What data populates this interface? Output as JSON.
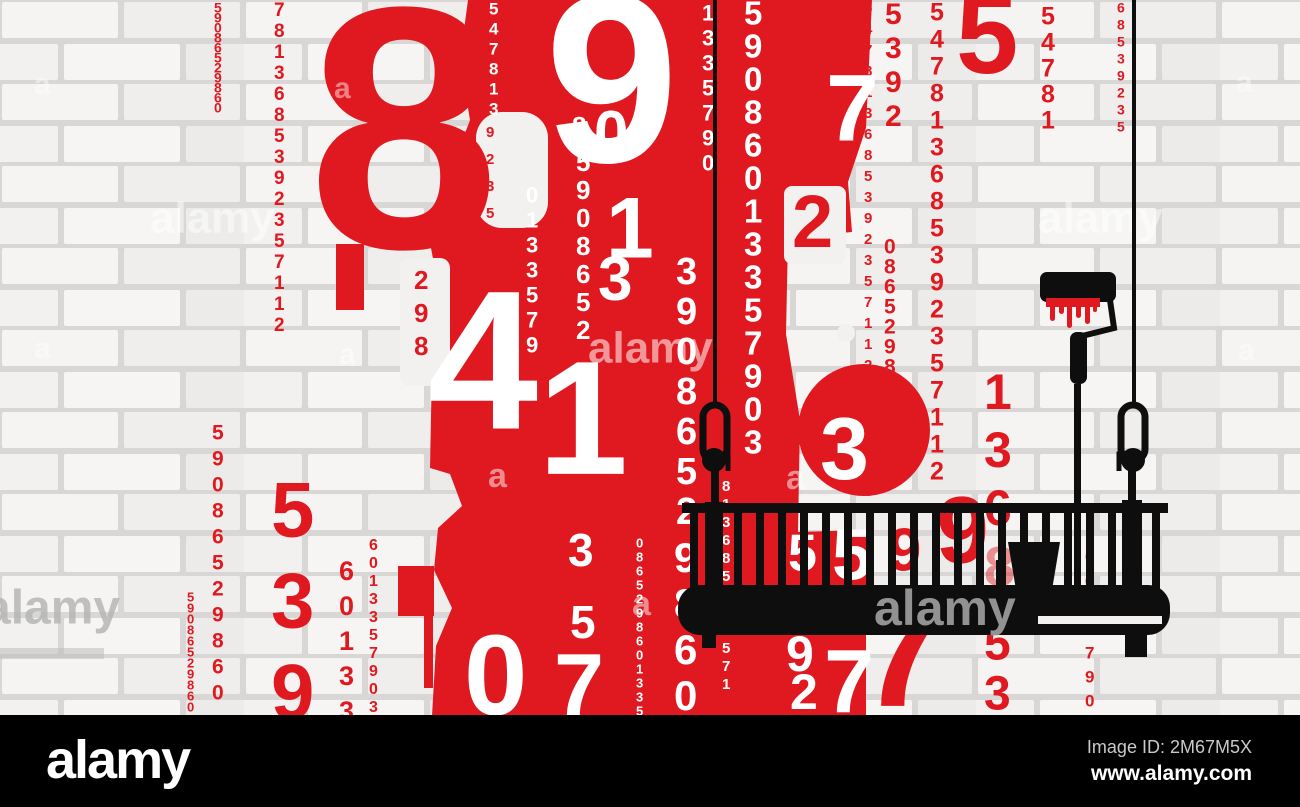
{
  "brand": {
    "logo": "alamy",
    "image_id": "Image ID: 2M67M5X",
    "website": "www.alamy.com"
  },
  "colors": {
    "red": "#e01920",
    "black": "#0e0e0e",
    "ground": "#000000",
    "wall_mortar": "#d8d7d5",
    "brick_light": "#f5f4f2",
    "brick_mid": "#efeeec",
    "white": "#ffffff",
    "watermark_gray": "#9a9a9a",
    "id_text": "#c9c9c9"
  },
  "digit_columns": [
    {
      "x": 214,
      "y": 2,
      "size": 14,
      "gap": 10,
      "color": "red",
      "text": "59086529860"
    },
    {
      "x": 274,
      "y": 2,
      "size": 19,
      "gap": 21,
      "color": "red",
      "text": "7813685392357112"
    },
    {
      "x": 486,
      "y": 126,
      "size": 15,
      "gap": 27,
      "color": "red",
      "text": "92357112"
    },
    {
      "x": 187,
      "y": 592,
      "size": 13,
      "gap": 11,
      "color": "red",
      "text": "59086529860"
    },
    {
      "x": 212,
      "y": 424,
      "size": 21,
      "gap": 26,
      "color": "red",
      "text": "59086529860"
    },
    {
      "x": 271,
      "y": 479,
      "size": 78,
      "gap": 91,
      "color": "red",
      "text": "539"
    },
    {
      "x": 339,
      "y": 560,
      "size": 27,
      "gap": 35,
      "color": "red",
      "text": "60133"
    },
    {
      "x": 369,
      "y": 538,
      "size": 16,
      "gap": 18,
      "color": "red",
      "text": "6013357903"
    },
    {
      "x": 414,
      "y": 270,
      "size": 26,
      "gap": 33,
      "color": "red",
      "text": "298"
    },
    {
      "x": 864,
      "y": 2,
      "size": 15,
      "gap": 21,
      "color": "red",
      "text": "547813685392357112865298"
    },
    {
      "x": 885,
      "y": 2,
      "size": 30,
      "gap": 34,
      "color": "red",
      "text": "5392"
    },
    {
      "x": 884,
      "y": 238,
      "size": 21,
      "gap": 20,
      "color": "red",
      "text": "0865298"
    },
    {
      "x": 930,
      "y": 2,
      "size": 25,
      "gap": 27,
      "color": "red",
      "text": "547813685392357112"
    },
    {
      "x": 1041,
      "y": 6,
      "size": 25,
      "gap": 26,
      "color": "red",
      "text": "54781"
    },
    {
      "x": 1117,
      "y": 2,
      "size": 14,
      "gap": 17,
      "color": "red",
      "text": "68539235"
    },
    {
      "x": 1085,
      "y": 550,
      "size": 17,
      "gap": 24,
      "color": "red",
      "text": "0635790"
    },
    {
      "x": 984,
      "y": 372,
      "size": 50,
      "gap": 58,
      "color": "red",
      "text": "136"
    },
    {
      "x": 984,
      "y": 624,
      "size": 48,
      "gap": 50,
      "color": "red",
      "text": "53"
    },
    {
      "x": 489,
      "y": 2,
      "size": 17,
      "gap": 20,
      "color": "white",
      "text": "547813"
    },
    {
      "x": 576,
      "y": 152,
      "size": 26,
      "gap": 28,
      "color": "white",
      "text": "5908652"
    },
    {
      "x": 526,
      "y": 186,
      "size": 22,
      "gap": 25,
      "color": "white",
      "text": "0133579"
    },
    {
      "x": 676,
      "y": 256,
      "size": 38,
      "gap": 40,
      "color": "white",
      "text": "3908652"
    },
    {
      "x": 744,
      "y": 0,
      "size": 33,
      "gap": 33,
      "color": "white",
      "text": "59086013357903"
    },
    {
      "x": 722,
      "y": 480,
      "size": 15,
      "gap": 18,
      "color": "white",
      "text": "813685523571"
    },
    {
      "x": 702,
      "y": 4,
      "size": 22,
      "gap": 25,
      "color": "white",
      "text": "1335790"
    },
    {
      "x": 636,
      "y": 538,
      "size": 13,
      "gap": 14,
      "color": "white",
      "text": "0865298601335"
    },
    {
      "x": 674,
      "y": 541,
      "size": 42,
      "gap": 46,
      "color": "white",
      "text": "9860"
    }
  ],
  "big_digits": [
    {
      "char": "8",
      "x": 308,
      "y": -8,
      "size": 345,
      "color": "red"
    },
    {
      "char": "5",
      "x": 446,
      "y": 128,
      "size": 60,
      "color": "red",
      "opacity": 0.45
    },
    {
      "char": "9",
      "x": 545,
      "y": -16,
      "size": 240,
      "color": "white"
    },
    {
      "char": "0",
      "x": 594,
      "y": 108,
      "size": 62,
      "color": "white"
    },
    {
      "char": "8",
      "x": 572,
      "y": 116,
      "size": 26,
      "color": "white"
    },
    {
      "char": "1",
      "x": 606,
      "y": 194,
      "size": 86,
      "color": "white"
    },
    {
      "char": "3",
      "x": 598,
      "y": 254,
      "size": 62,
      "color": "white"
    },
    {
      "char": "4",
      "x": 428,
      "y": 282,
      "size": 198,
      "color": "white"
    },
    {
      "char": "1",
      "x": 538,
      "y": 354,
      "size": 162,
      "color": "white"
    },
    {
      "char": "2",
      "x": 792,
      "y": 192,
      "size": 74,
      "color": "red"
    },
    {
      "char": "7",
      "x": 826,
      "y": 70,
      "size": 95,
      "color": "white"
    },
    {
      "char": "5",
      "x": 956,
      "y": -10,
      "size": 112,
      "color": "red"
    },
    {
      "char": "3",
      "x": 820,
      "y": 414,
      "size": 88,
      "color": "white"
    },
    {
      "char": "7",
      "x": 858,
      "y": 586,
      "size": 162,
      "color": "red"
    },
    {
      "char": "9",
      "x": 888,
      "y": 526,
      "size": 60,
      "color": "red"
    },
    {
      "char": "9",
      "x": 936,
      "y": 492,
      "size": 95,
      "color": "red"
    },
    {
      "char": "8",
      "x": 984,
      "y": 544,
      "size": 56,
      "color": "red",
      "opacity": 0.45
    },
    {
      "char": "3",
      "x": 568,
      "y": 532,
      "size": 46,
      "color": "white"
    },
    {
      "char": "5",
      "x": 570,
      "y": 604,
      "size": 46,
      "color": "white"
    },
    {
      "char": "0",
      "x": 464,
      "y": 630,
      "size": 114,
      "color": "white"
    },
    {
      "char": "7",
      "x": 554,
      "y": 650,
      "size": 90,
      "color": "white"
    },
    {
      "char": "5",
      "x": 788,
      "y": 532,
      "size": 52,
      "color": "white"
    },
    {
      "char": "5",
      "x": 832,
      "y": 526,
      "size": 72,
      "color": "white"
    },
    {
      "char": "9",
      "x": 786,
      "y": 634,
      "size": 50,
      "color": "white"
    },
    {
      "char": "2",
      "x": 790,
      "y": 672,
      "size": 50,
      "color": "white"
    },
    {
      "char": "7",
      "x": 824,
      "y": 646,
      "size": 90,
      "color": "white"
    }
  ],
  "watermark_tiles": [
    {
      "text": "alamy",
      "x": 150,
      "y": 200,
      "size": 44,
      "fill": "#ffffff",
      "opacity": 0.5,
      "layer": "wall"
    },
    {
      "text": "alamy",
      "x": 588,
      "y": 330,
      "size": 44,
      "fill": "#ffffff",
      "opacity": 0.55,
      "layer": "wall"
    },
    {
      "text": "alamy",
      "x": 1038,
      "y": 200,
      "size": 44,
      "fill": "#ffffff",
      "opacity": 0.5,
      "layer": "wall"
    },
    {
      "text": "alamy",
      "x": -16,
      "y": 588,
      "size": 48,
      "fill": "#b6b6b6",
      "opacity": 0.85,
      "layer": "wall"
    },
    {
      "text": "a",
      "x": 34,
      "y": 72,
      "size": 30,
      "fill": "#ffffff",
      "opacity": 0.45,
      "layer": "wall"
    },
    {
      "text": "a",
      "x": 334,
      "y": 76,
      "size": 30,
      "fill": "#ffffff",
      "opacity": 0.45,
      "layer": "wall"
    },
    {
      "text": "a",
      "x": 1236,
      "y": 70,
      "size": 30,
      "fill": "#ffffff",
      "opacity": 0.45,
      "layer": "wall"
    },
    {
      "text": "a",
      "x": 34,
      "y": 336,
      "size": 30,
      "fill": "#ffffff",
      "opacity": 0.45,
      "layer": "wall"
    },
    {
      "text": "a",
      "x": 339,
      "y": 342,
      "size": 30,
      "fill": "#ffffff",
      "opacity": 0.5,
      "layer": "wall"
    },
    {
      "text": "a",
      "x": 1238,
      "y": 338,
      "size": 30,
      "fill": "#ffffff",
      "opacity": 0.45,
      "layer": "wall"
    },
    {
      "text": "a",
      "x": 488,
      "y": 462,
      "size": 34,
      "fill": "#ffffff",
      "opacity": 0.5,
      "layer": "wall"
    },
    {
      "text": "a",
      "x": 786,
      "y": 464,
      "size": 34,
      "fill": "#ffffff",
      "opacity": 0.5,
      "layer": "wall"
    },
    {
      "text": "a",
      "x": 632,
      "y": 590,
      "size": 34,
      "fill": "#ffffff",
      "opacity": 0.5,
      "layer": "wall"
    },
    {
      "text": "alamy",
      "x": 874,
      "y": 588,
      "size": 50,
      "fill": "#9a9a9a",
      "opacity": 0.95,
      "layer": "front"
    }
  ]
}
